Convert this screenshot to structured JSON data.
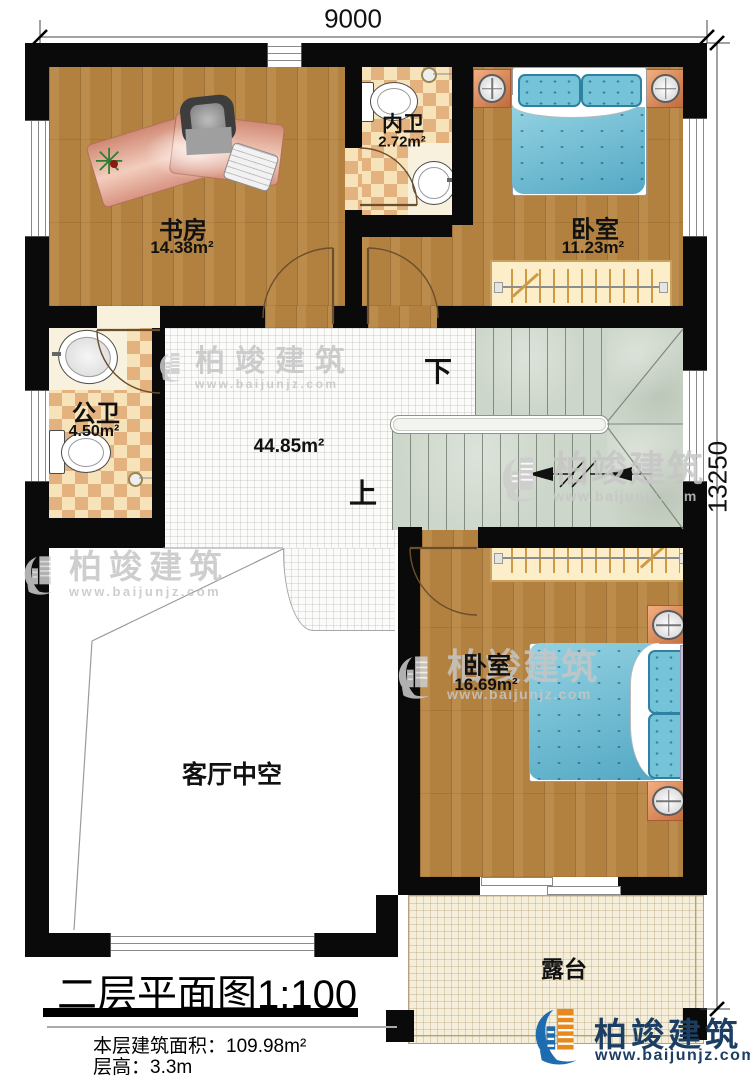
{
  "dimensions": {
    "width": "9000",
    "height": "13250"
  },
  "rooms": [
    {
      "name": "书房",
      "area": "14.38m²"
    },
    {
      "name": "内卫",
      "area": "2.72m²"
    },
    {
      "name": "卧室",
      "area": "11.23m²"
    },
    {
      "name": "公卫",
      "area": "4.50m²"
    },
    {
      "area": "44.85m²"
    },
    {
      "name": "卧室",
      "area": "16.69m²"
    },
    {
      "name": "客厅中空"
    },
    {
      "name": "露台"
    }
  ],
  "stairs": {
    "up": "上",
    "down": "下"
  },
  "title_block": {
    "title": "二层平面图",
    "scale": "1:100",
    "area_label": "本层建筑面积：",
    "area_value": "109.98m²",
    "height_label": "层高：",
    "height_value": "3.3m"
  },
  "branding": {
    "name": "柏竣建筑",
    "url": "www.baijunjz.com"
  },
  "palette": {
    "wall": "#0a0a0a",
    "wood": "#b2803f",
    "tile": "#fbfbf9",
    "checker_light": "#f7e3ba",
    "checker_dark": "#e3b27f",
    "stair": "#cdd6ca",
    "bed_blue": "#74c3d8",
    "nightstand_orange": "#e09a66",
    "terrace": "#f4eeda",
    "logo_navy": "#1c3e63",
    "logo_orange": "#e8891d",
    "logo_blue": "#1e6cb0"
  }
}
